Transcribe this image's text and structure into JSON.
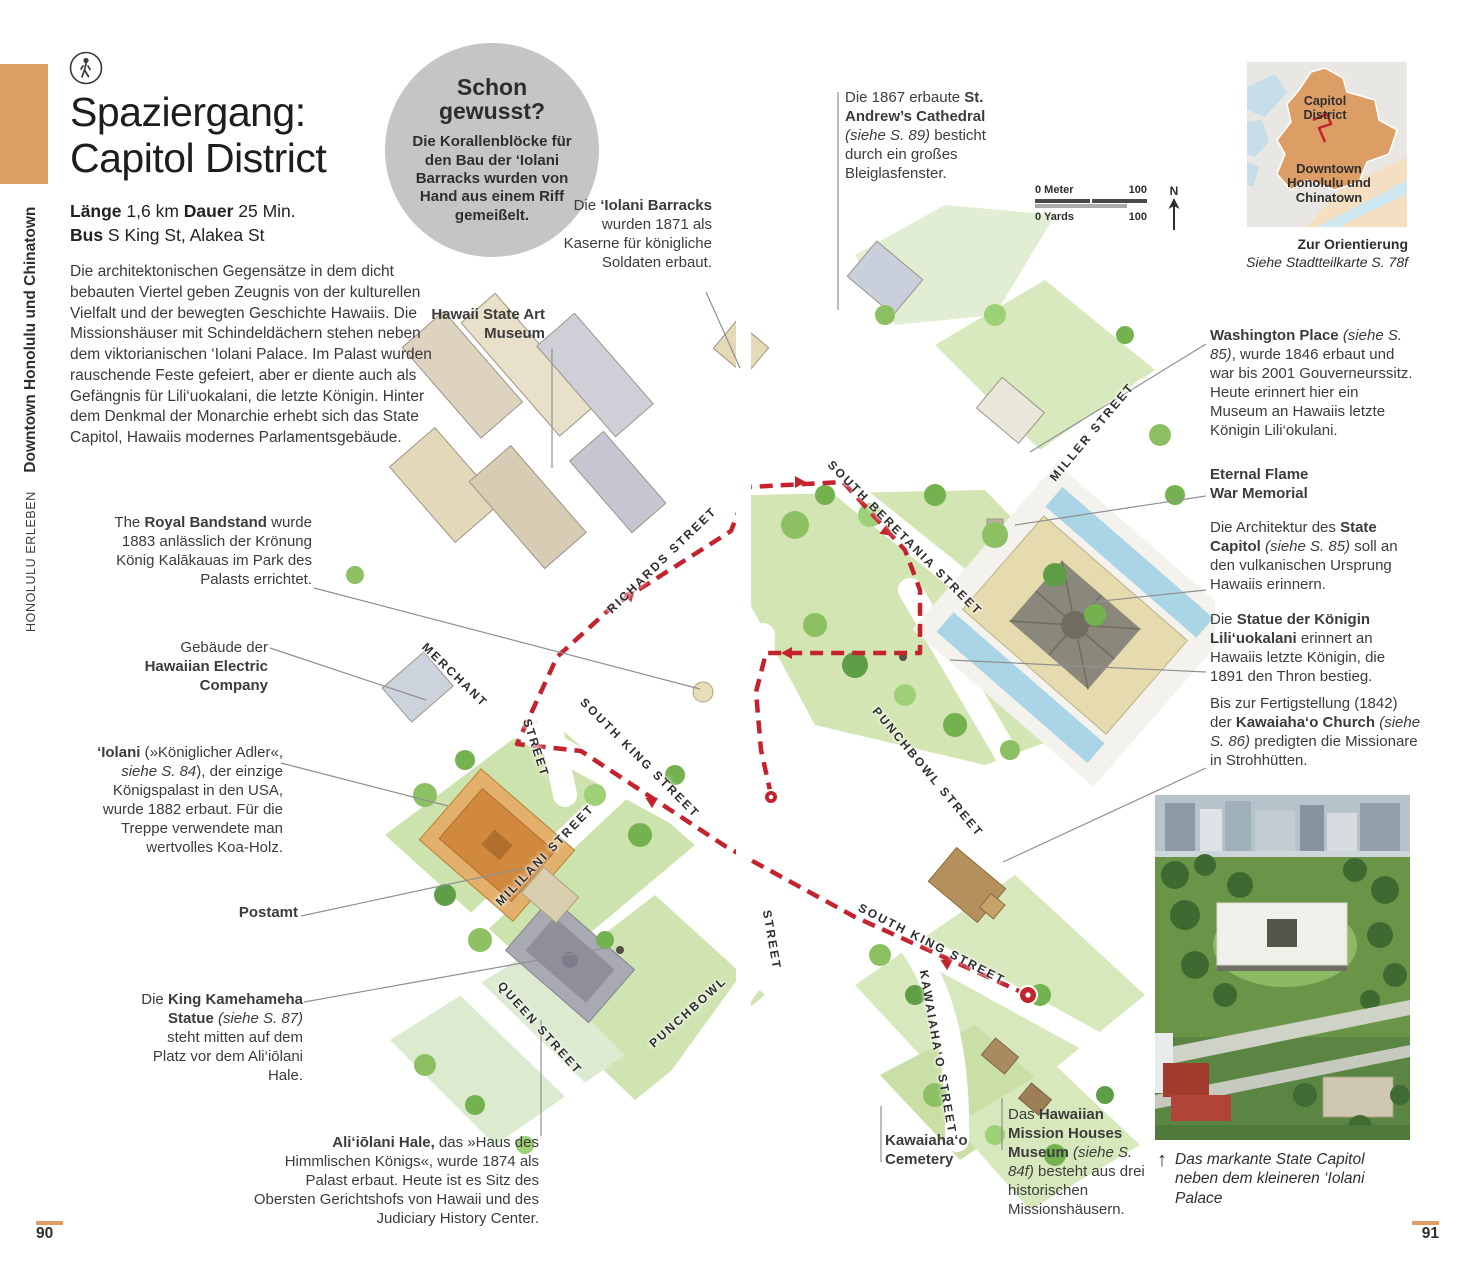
{
  "sidebar": {
    "section": "HONOLULU ERLEBEN",
    "chapter": "Downtown Honolulu und Chinatown"
  },
  "header": {
    "title_line1": "Spaziergang:",
    "title_line2": "Capitol District",
    "meta_line1": {
      "segments": [
        {
          "t": "Länge",
          "b": 1
        },
        {
          "t": " 1,6 km   "
        },
        {
          "t": "Dauer",
          "b": 1
        },
        {
          "t": " 25 Min."
        }
      ]
    },
    "meta_line2": {
      "segments": [
        {
          "t": "Bus",
          "b": 1
        },
        {
          "t": " S King St, Alakea St"
        }
      ]
    },
    "intro": "Die architektonischen Gegensätze in dem dicht bebauten Viertel geben Zeugnis von der kulturellen Vielfalt und der bewegten Geschichte Hawaiis. Die Missionshäuser mit Schindeldächern stehen neben dem viktorianischen ‘Iolani Palace. Im Palast wurden rauschende Feste gefeiert, aber er diente auch als Gefängnis für Lili‘uokalani, die letzte Königin. Hinter dem Denkmal der Monarchie erhebt sich das State Capitol, Hawaiis modernes Parlamentsgebäude."
  },
  "did_you_know": {
    "title": "Schon gewusst?",
    "body": "Die Korallenblöcke für den Bau der ‘Iolani Barracks wurden von Hand aus einem Riff gemeißelt."
  },
  "annotations": {
    "barracks": {
      "segments": [
        {
          "t": "Die "
        },
        {
          "t": "‘Iolani Barracks",
          "b": 1
        },
        {
          "t": " wurden 1871 als Kaserne für königliche Soldaten erbaut."
        }
      ]
    },
    "art_museum": {
      "segments": [
        {
          "t": "Hawaii State Art Museum",
          "b": 1
        }
      ]
    },
    "st_andrews": {
      "segments": [
        {
          "t": "Die 1867 erbaute "
        },
        {
          "t": "St. Andrew’s Cathedral",
          "b": 1
        },
        {
          "t": " "
        },
        {
          "t": "(siehe S. 89)",
          "i": 1
        },
        {
          "t": " besticht durch ein großes Bleiglasfenster."
        }
      ]
    },
    "washington": {
      "segments": [
        {
          "t": "Washington Place",
          "b": 1
        },
        {
          "t": " "
        },
        {
          "t": "(siehe S. 85)",
          "i": 1
        },
        {
          "t": ", wurde 1846 erbaut und war bis 2001 Gouverneurssitz. Heute erinnert hier ein Museum an Hawaiis letzte Königin Lili‘okulani."
        }
      ]
    },
    "eternal_flame": {
      "segments": [
        {
          "t": "Eternal Flame",
          "b": 1
        },
        {
          "br": 1
        },
        {
          "t": "War Memorial",
          "b": 1
        }
      ]
    },
    "state_capitol": {
      "segments": [
        {
          "t": "Die Architektur des "
        },
        {
          "t": "State Capitol",
          "b": 1
        },
        {
          "t": " "
        },
        {
          "t": "(siehe S. 85)",
          "i": 1
        },
        {
          "t": " soll an den vulkanischen Ursprung Hawaiis erinnern."
        }
      ]
    },
    "liliuokalani": {
      "segments": [
        {
          "t": "Die "
        },
        {
          "t": "Statue der Königin Lili‘uokalani",
          "b": 1
        },
        {
          "t": " erinnert an Hawaiis letzte Königin, die 1891 den Thron bestieg."
        }
      ]
    },
    "kawaiahao_church": {
      "segments": [
        {
          "t": "Bis zur Fertigstellung (1842) der "
        },
        {
          "t": "Kawaiaha‘o Church",
          "b": 1
        },
        {
          "t": " "
        },
        {
          "t": "(siehe S. 86)",
          "i": 1
        },
        {
          "t": " predigten die Missionare in Strohhütten."
        }
      ]
    },
    "royal_bandstand": {
      "segments": [
        {
          "t": "The "
        },
        {
          "t": "Royal Bandstand",
          "b": 1
        },
        {
          "t": " wurde 1883 anlässlich der Krönung König Kalākauas im Park des Palasts errichtet."
        }
      ]
    },
    "hawaiian_electric": {
      "segments": [
        {
          "t": "Gebäude der"
        },
        {
          "br": 1
        },
        {
          "t": "Hawaiian Electric Company",
          "b": 1
        }
      ]
    },
    "iolani": {
      "segments": [
        {
          "t": "‘Iolani",
          "b": 1
        },
        {
          "t": " (»Königlicher Adler«, "
        },
        {
          "t": "siehe S. 84",
          "i": 1
        },
        {
          "t": "), der einzige Königspalast in den USA, wurde 1882 erbaut. Für die Treppe verwendete man wertvolles Koa-Holz."
        }
      ]
    },
    "postamt": {
      "segments": [
        {
          "t": "Postamt",
          "b": 1
        }
      ]
    },
    "kamehameha": {
      "segments": [
        {
          "t": "Die "
        },
        {
          "t": "King Kamehameha Statue",
          "b": 1
        },
        {
          "t": " "
        },
        {
          "t": "(siehe S. 87)",
          "i": 1
        },
        {
          "t": " steht mitten auf dem Platz vor dem Ali‘iōlani Hale."
        }
      ]
    },
    "aliiolani": {
      "segments": [
        {
          "t": "Ali‘iōlani Hale,",
          "b": 1
        },
        {
          "t": " das »Haus des Himmlischen Königs«, wurde 1874 als Palast erbaut. Heute ist es Sitz des Obersten Gerichtshofs von Hawaii und des Judiciary History Center."
        }
      ]
    },
    "cemetery": {
      "segments": [
        {
          "t": "Kawaiaha‘o Cemetery",
          "b": 1
        }
      ]
    },
    "mission_houses": {
      "segments": [
        {
          "t": "Das "
        },
        {
          "t": "Hawaiian Mission Houses Museum",
          "b": 1
        },
        {
          "t": " "
        },
        {
          "t": "(siehe S. 84f)",
          "i": 1
        },
        {
          "t": " besteht aus drei historischen Missionshäusern."
        }
      ]
    }
  },
  "map": {
    "route_color": "#c4232e",
    "streets": [
      {
        "label": "RICHARDS STREET"
      },
      {
        "label": "MERCHANT"
      },
      {
        "label": "STREET"
      },
      {
        "label": "SOUTH KING STREET"
      },
      {
        "label": "MILILANI STREET"
      },
      {
        "label": "QUEEN STREET"
      },
      {
        "label": "PUNCHBOWL"
      },
      {
        "label": "STREET"
      },
      {
        "label": "SOUTH BERETANIA STREET"
      },
      {
        "label": "MILLER STREET"
      },
      {
        "label": "PUNCHBOWL STREET"
      },
      {
        "label": "SOUTH KING STREET"
      },
      {
        "label": "KAWAIAHA‘O STREET"
      }
    ]
  },
  "scale_bar": {
    "meters_start": "0 Meter",
    "meters_end": "100",
    "yards_start": "0 Yards",
    "yards_end": "100",
    "north_label": "N"
  },
  "locator": {
    "district_label": "Capitol District",
    "area_label": "Downtown Honolulu und Chinatown",
    "orientation_title": "Zur Orientierung",
    "orientation_note": "Siehe Stadtteilkarte S. 78f"
  },
  "photo": {
    "caption_arrow": "↑",
    "caption": {
      "segments": [
        {
          "t": "Das markante State Capitol neben dem kleineren ‘Iolani Palace",
          "i": 1
        }
      ]
    }
  },
  "page": {
    "left_number": "90",
    "right_number": "91"
  }
}
